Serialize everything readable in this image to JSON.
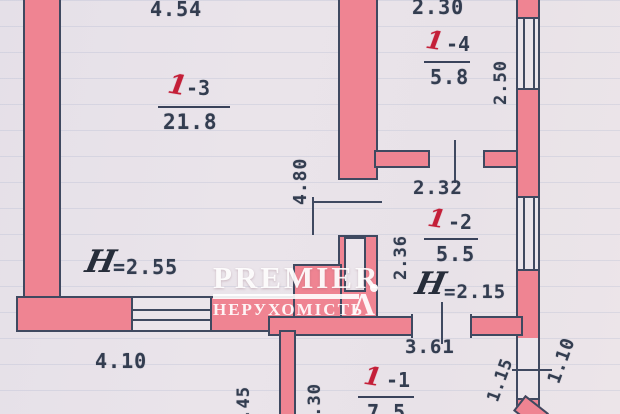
{
  "document_type": "apartment floor plan (scanned photo)",
  "colors": {
    "wall_fill": "#ef8492",
    "wall_outline": "#3f4960",
    "paper": "#e9e3ea",
    "room_label_red": "#c41f38",
    "dimension_text": "#333d50",
    "watermark": "#ffffff"
  },
  "watermark": {
    "brand": "PREMIER",
    "tagline": "НЕРУХОМІСТЬ",
    "mark": "Λ"
  },
  "rooms": {
    "room_1_3": {
      "number": "1",
      "suffix": "-3",
      "area": "21.8",
      "height_symbol": "H",
      "height_value": "=2.55"
    },
    "room_1_4": {
      "number": "1",
      "suffix": "-4",
      "area": "5.8"
    },
    "room_1_2": {
      "number": "1",
      "suffix": "-2",
      "area": "5.5",
      "height_symbol": "H",
      "height_value": "=2.15"
    },
    "room_1_1": {
      "number": "1",
      "suffix": "-1",
      "area": "7.5"
    }
  },
  "dimensions": {
    "top_width_left": "4.54",
    "top_width_right": "2.30",
    "room3_depth": "4.80",
    "room4_depth": "2.50",
    "corridor_width": "2.32",
    "room2_depth": "2.36",
    "room1_width": "3.61",
    "bottom_left_width": "4.10",
    "bottom_left_depth": "2.45",
    "bottom_center_depth": "2.30",
    "right_opening_inner": "1.15",
    "right_opening_outer": "1.10"
  }
}
